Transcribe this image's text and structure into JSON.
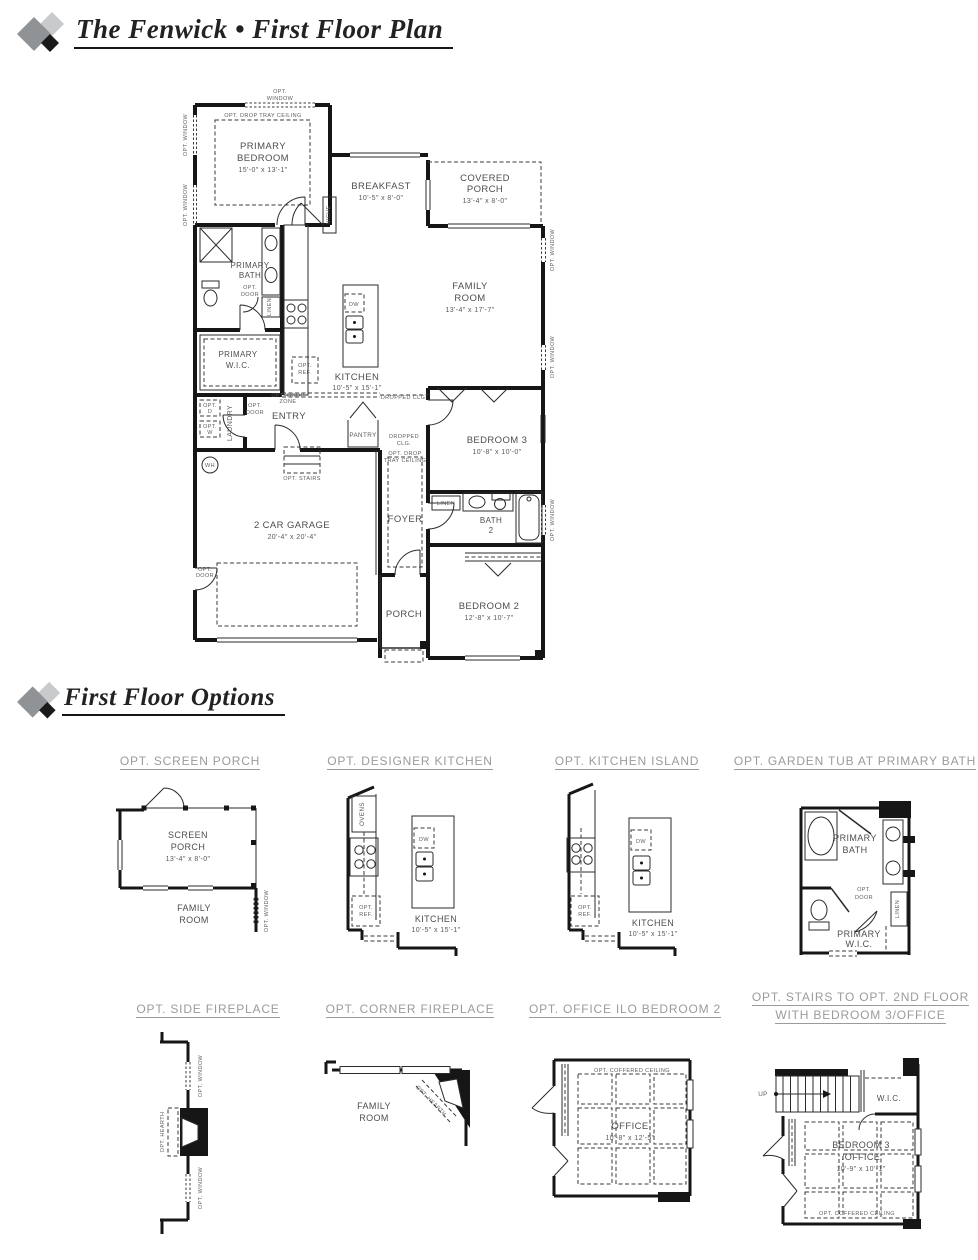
{
  "page": {
    "title_first_floor": "The Fenwick • First Floor Plan",
    "title_options": "First Floor Options"
  },
  "colors": {
    "wall": "#161616",
    "label": "#4e4e4e",
    "heading_gray": "#9b9b9b",
    "logo_gray": "#909396",
    "logo_light": "#c8cacc",
    "logo_black": "#1a1a1a"
  },
  "plan": {
    "rooms": {
      "primary_bedroom": {
        "lines": [
          "PRIMARY",
          "BEDROOM"
        ],
        "dims": "15'-0\" x 13'-1\""
      },
      "breakfast": {
        "lines": [
          "BREAKFAST"
        ],
        "dims": "10'-5\" x 8'-0\""
      },
      "covered_porch": {
        "lines": [
          "COVERED",
          "PORCH"
        ],
        "dims": "13'-4\" x 8'-0\""
      },
      "family_room": {
        "lines": [
          "FAMILY",
          "ROOM"
        ],
        "dims": "13'-4\" x 17'-7\""
      },
      "primary_bath": {
        "lines": [
          "PRIMARY",
          "BATH"
        ]
      },
      "primary_wic": {
        "lines": [
          "PRIMARY",
          "W.I.C."
        ]
      },
      "kitchen": {
        "lines": [
          "KITCHEN"
        ],
        "dims": "10'-5\" x 15'-1\""
      },
      "entry": {
        "lines": [
          "ENTRY"
        ]
      },
      "laundry": {
        "lines": [
          "LAUNDRY"
        ]
      },
      "pantry": {
        "lines": [
          "PANTRY"
        ]
      },
      "foyer": {
        "lines": [
          "FOYER"
        ]
      },
      "garage": {
        "lines": [
          "2 CAR GARAGE"
        ],
        "dims": "20'-4\" x 20'-4\""
      },
      "bedroom3": {
        "lines": [
          "BEDROOM 3"
        ],
        "dims": "10'-8\" x 10'-0\""
      },
      "bath2": {
        "lines": [
          "BATH",
          "2"
        ]
      },
      "bedroom2": {
        "lines": [
          "BEDROOM 2"
        ],
        "dims": "12'-8\" x 10'-7\""
      },
      "porch": {
        "lines": [
          "PORCH"
        ]
      }
    },
    "ann": {
      "opt": "OPT.",
      "window": "WINDOW",
      "door": "DOOR",
      "ref": "REF.",
      "d": "D",
      "w": "W",
      "opt_window": "OPT. WINDOW",
      "opt_door": "OPT. DOOR",
      "opt_drop": "OPT. DROP",
      "zone": "ZONE",
      "tray_ceiling": "TRAY CEILING",
      "opt_drop_tray_ceiling": "OPT. DROP TRAY CEILING",
      "dropped_clg": "DROPPED CLG.",
      "dropped": "DROPPED",
      "clg": "CLG.",
      "opt_stairs": "OPT. STAIRS",
      "niche": "NICHE",
      "linen": "LINEN",
      "dw": "DW",
      "wh": "WH",
      "ovens": "OVENS",
      "opt_hearth": "OPT. HEARTH",
      "opt_coffered_ceiling": "OPT. COFFERED CEILING",
      "up": "UP",
      "wic": "W.I.C."
    }
  },
  "options": [
    {
      "heading": "OPT. SCREEN PORCH",
      "room": {
        "lines": [
          "SCREEN",
          "PORCH"
        ],
        "dims": "13'-4\" x 8'-0\""
      },
      "room2": {
        "lines": [
          "FAMILY",
          "ROOM"
        ]
      }
    },
    {
      "heading": "OPT. DESIGNER KITCHEN",
      "room": {
        "lines": [
          "KITCHEN"
        ],
        "dims": "10'-5\" x 15'-1\""
      }
    },
    {
      "heading": "OPT. KITCHEN ISLAND",
      "room": {
        "lines": [
          "KITCHEN"
        ],
        "dims": "10'-5\" x 15'-1\""
      }
    },
    {
      "heading": "OPT. GARDEN TUB AT PRIMARY BATH",
      "room": {
        "lines": [
          "PRIMARY",
          "BATH"
        ]
      },
      "room2": {
        "lines": [
          "PRIMARY",
          "W.I.C."
        ]
      }
    },
    {
      "heading": "OPT. SIDE FIREPLACE"
    },
    {
      "heading": "OPT. CORNER FIREPLACE",
      "room": {
        "lines": [
          "FAMILY",
          "ROOM"
        ]
      }
    },
    {
      "heading": "OPT. OFFICE ILO BEDROOM 2",
      "room": {
        "lines": [
          "OFFICE"
        ],
        "dims": "10'-8\" x 12'-5\""
      }
    },
    {
      "heading": "OPT. STAIRS TO OPT. 2ND FLOOR",
      "heading2": "WITH BEDROOM 3/OFFICE",
      "room": {
        "lines": [
          "BEDROOM 3",
          "/OFFICE"
        ],
        "dims": "10'-9\" x 10'-1\""
      }
    }
  ]
}
